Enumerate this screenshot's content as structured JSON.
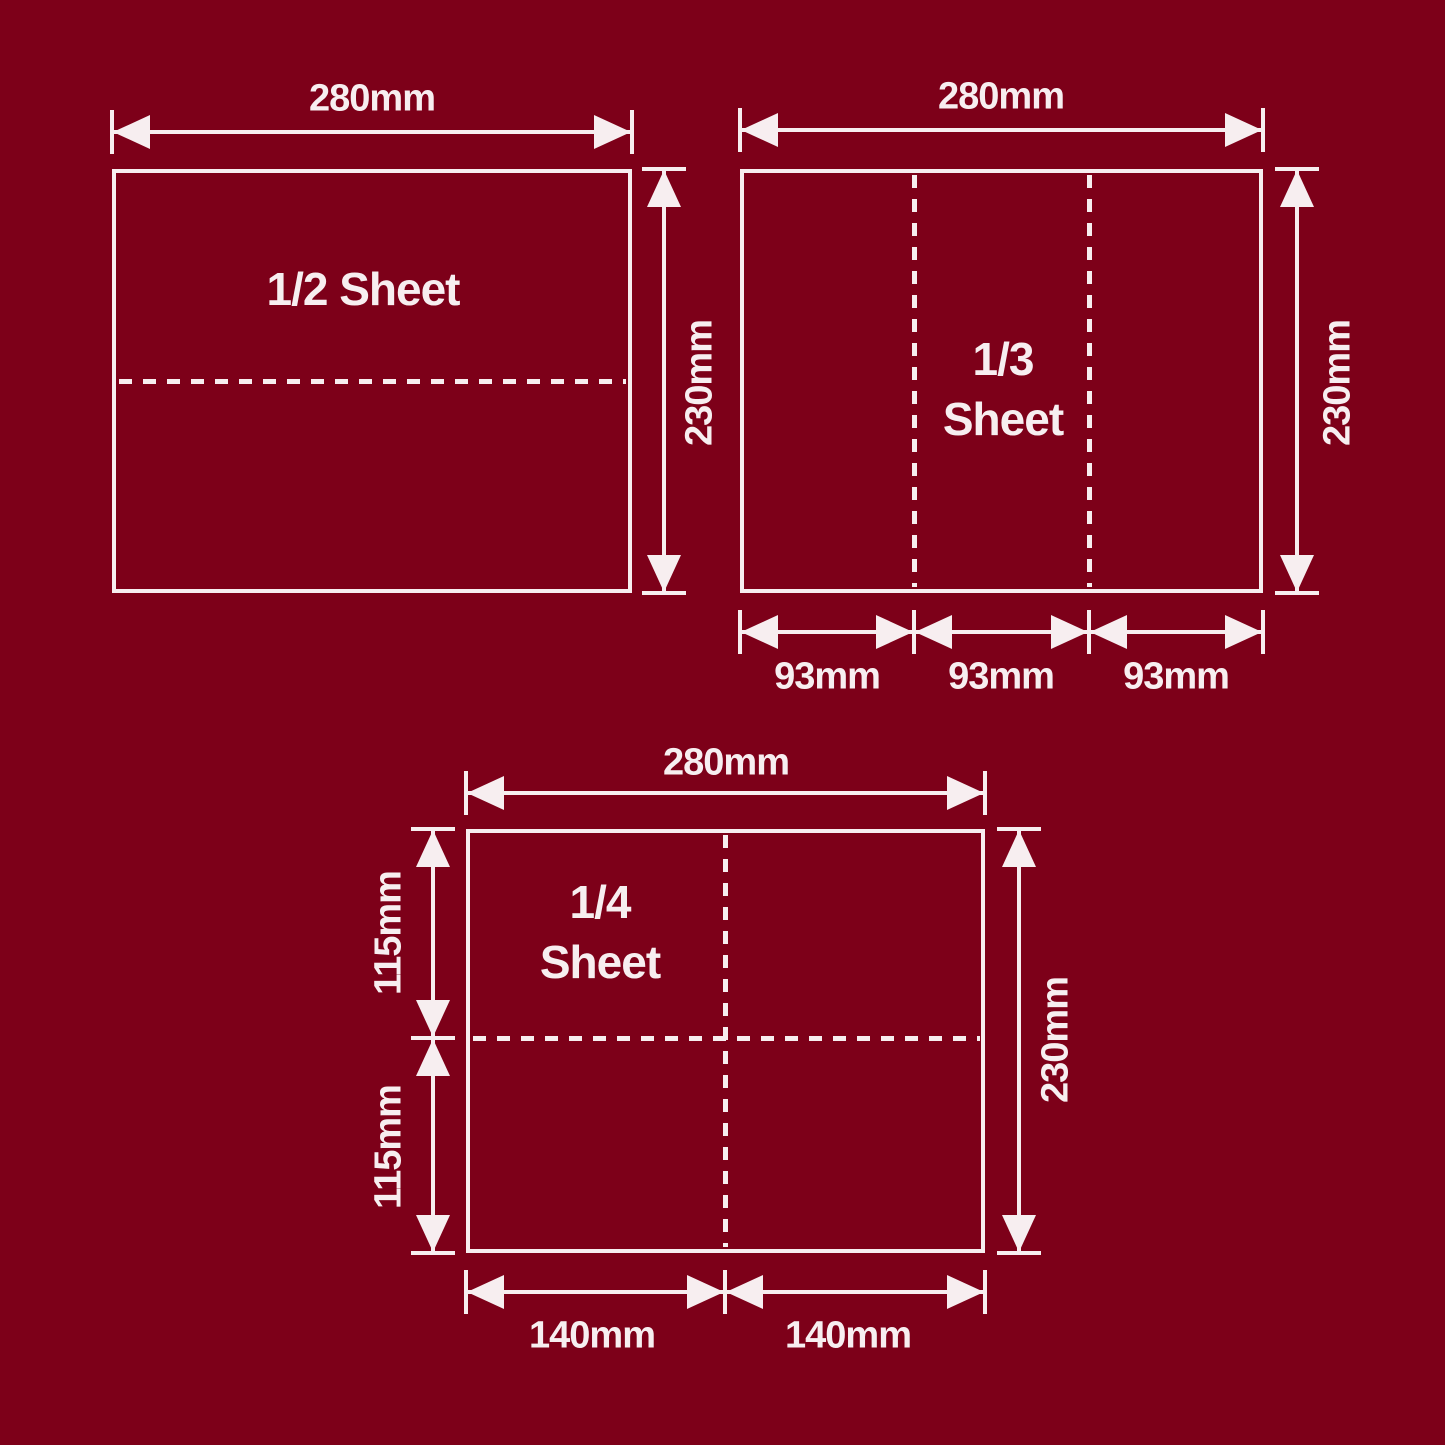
{
  "colors": {
    "background": "#7d0019",
    "foreground": "#f7eef0"
  },
  "diagrams": [
    {
      "id": "half-sheet",
      "title": "1/2 Sheet",
      "width_label": "280mm",
      "height_label": "230mm"
    },
    {
      "id": "third-sheet",
      "title_line1": "1/3",
      "title_line2": "Sheet",
      "width_label": "280mm",
      "height_label": "230mm",
      "bottom_labels": [
        "93mm",
        "93mm",
        "93mm"
      ]
    },
    {
      "id": "quarter-sheet",
      "title_line1": "1/4",
      "title_line2": "Sheet",
      "width_label": "280mm",
      "height_label": "230mm",
      "left_labels": [
        "115mm",
        "115mm"
      ],
      "bottom_labels": [
        "140mm",
        "140mm"
      ]
    }
  ]
}
